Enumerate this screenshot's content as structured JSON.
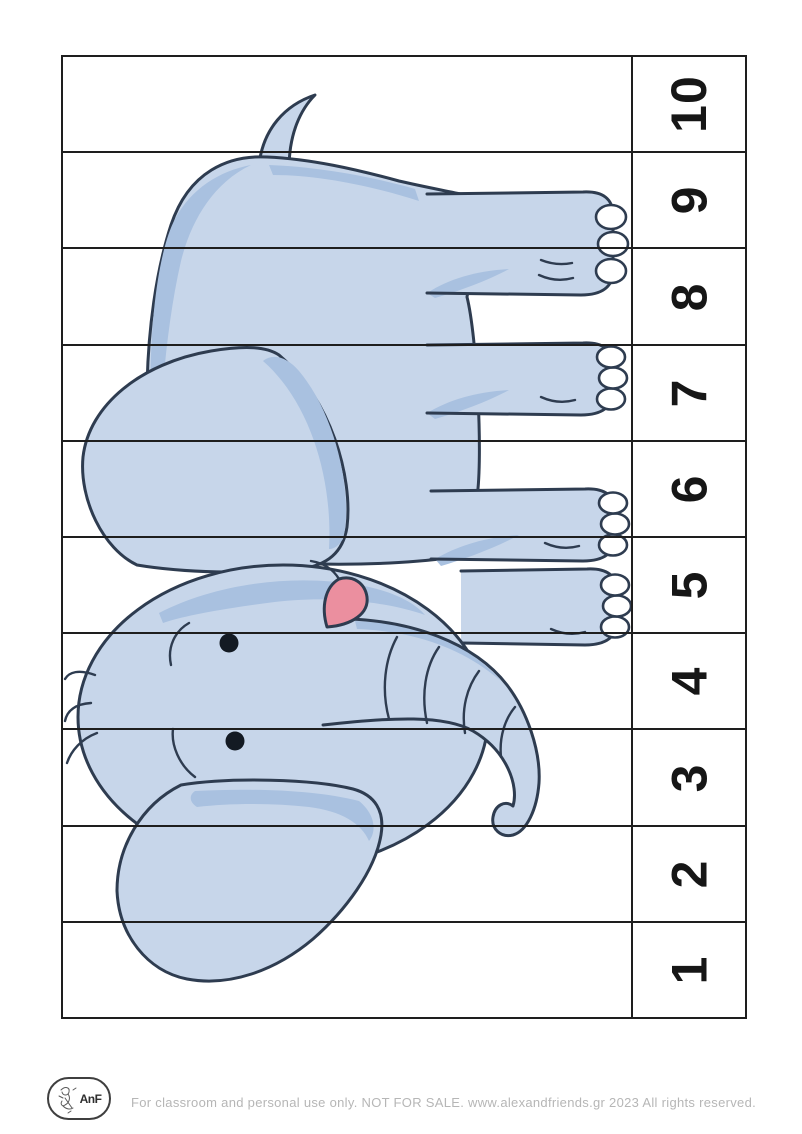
{
  "colors": {
    "paper": "#ffffff",
    "grid": "#1e1e1e",
    "number": "#161616",
    "body": "#c7d6ea",
    "shade": "#a9c1e0",
    "outline": "#2e3c50",
    "mouth": "#eb8f9f",
    "eye": "#131a23",
    "nail": "#ffffff",
    "footer_text": "#b6b6b6",
    "logo_ink": "#3f3f3f"
  },
  "puzzle": {
    "numbers": [
      "10",
      "9",
      "8",
      "7",
      "6",
      "5",
      "4",
      "3",
      "2",
      "1"
    ]
  },
  "illustration": {
    "subject": "cartoon-elephant-rotated-90-ccw"
  },
  "footer": {
    "logo_text": "AnF",
    "license_text": "For classroom and personal use only. NOT FOR SALE. www.alexandfriends.gr 2023  All rights reserved."
  }
}
